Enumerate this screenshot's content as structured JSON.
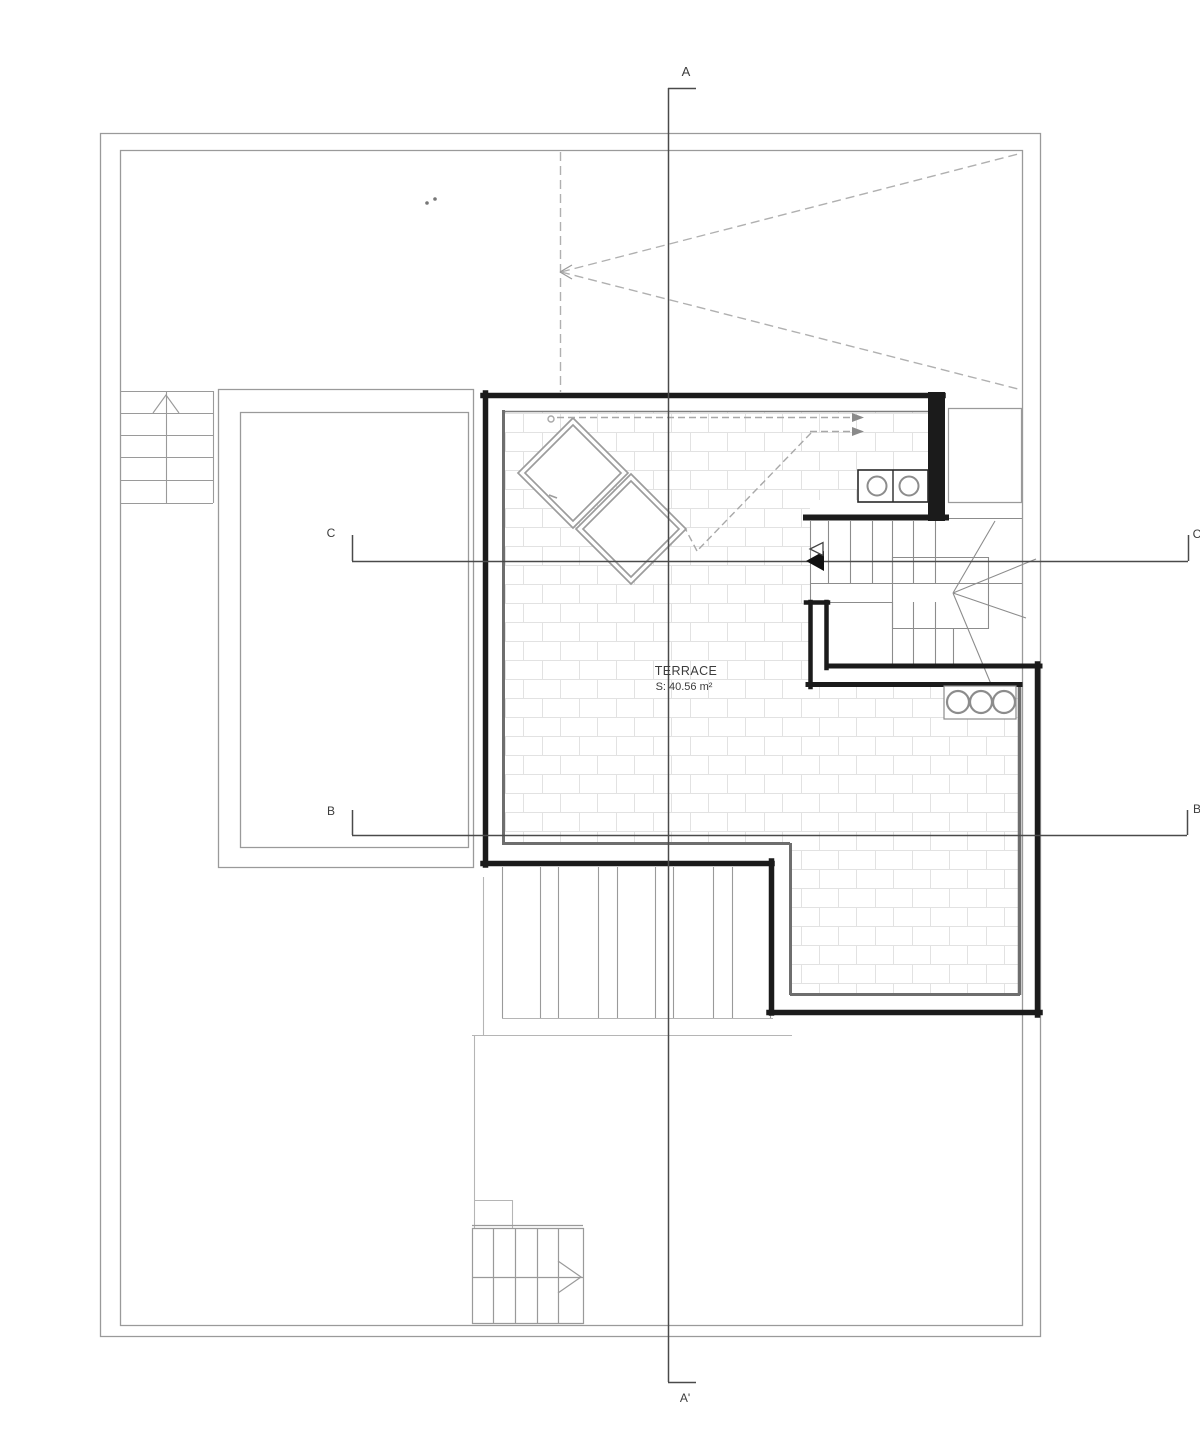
{
  "drawing": {
    "kind_note": "architectural floor plan",
    "section_markers": {
      "a_top": "A",
      "a_bottom": "A'",
      "b_left": "B",
      "b_right": "B",
      "c_left": "C",
      "c_right": "C"
    },
    "room_label": {
      "name": "TERRACE",
      "area": "S: 40.56 m²"
    },
    "colors": {
      "background": "#ffffff",
      "wall": "#1b1b1b",
      "boundary": "#9a9a9a",
      "detail_line": "#8c8c8c",
      "brick_line": "#e2e2e2",
      "dashed_line": "#a8a8a8",
      "section_line": "#4a4a4a",
      "text": "#3c3c3c"
    },
    "icons": {
      "stair_up_arrow": "up-arrow-icon",
      "stair_right_arrow": "right-arrow-icon",
      "flow_arrows": "right-arrow-icon",
      "section_cut_arrow": "left-arrow-icon",
      "roof_slope_arrow": "left-arrow-icon"
    }
  }
}
